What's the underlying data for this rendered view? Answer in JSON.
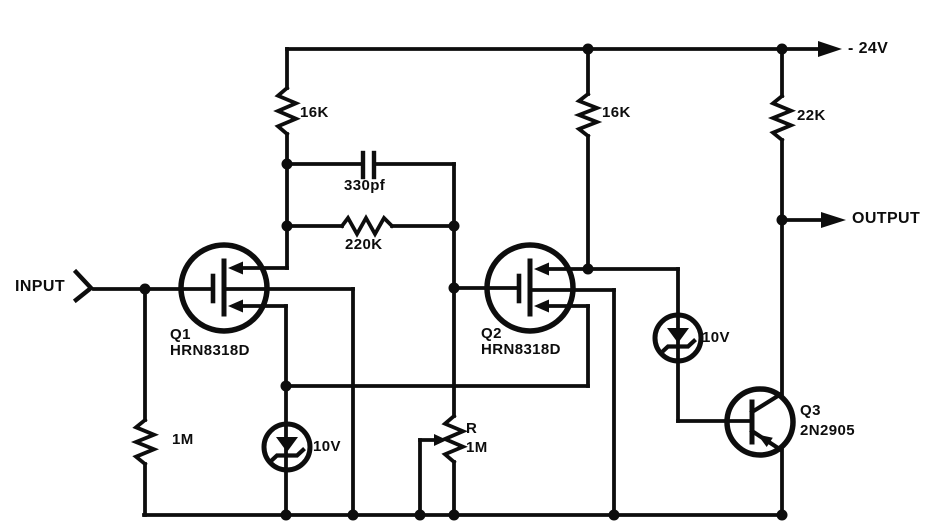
{
  "terminals": {
    "input": {
      "label": "INPUT"
    },
    "supply": {
      "label": "- 24V"
    },
    "output": {
      "label": "OUTPUT"
    }
  },
  "components": {
    "r1_16k": {
      "type": "resistor",
      "value": "16K"
    },
    "r2_16k": {
      "type": "resistor",
      "value": "16K"
    },
    "r3_22k": {
      "type": "resistor",
      "value": "22K"
    },
    "r4_220k": {
      "type": "resistor",
      "value": "220K"
    },
    "r5_1m": {
      "type": "resistor",
      "value": "1M"
    },
    "pot_r_1m": {
      "type": "potentiometer",
      "name": "R",
      "value": "1M"
    },
    "c1_330pf": {
      "type": "capacitor",
      "value": "330pf"
    },
    "zener_left_10v": {
      "type": "zener-diode",
      "value": "10V"
    },
    "zener_right_10v": {
      "type": "zener-diode",
      "value": "10V"
    },
    "q1": {
      "type": "mosfet",
      "name": "Q1",
      "part": "HRN8318D"
    },
    "q2": {
      "type": "mosfet",
      "name": "Q2",
      "part": "HRN8318D"
    },
    "q3": {
      "type": "pnp-transistor",
      "name": "Q3",
      "part": "2N2905"
    }
  }
}
